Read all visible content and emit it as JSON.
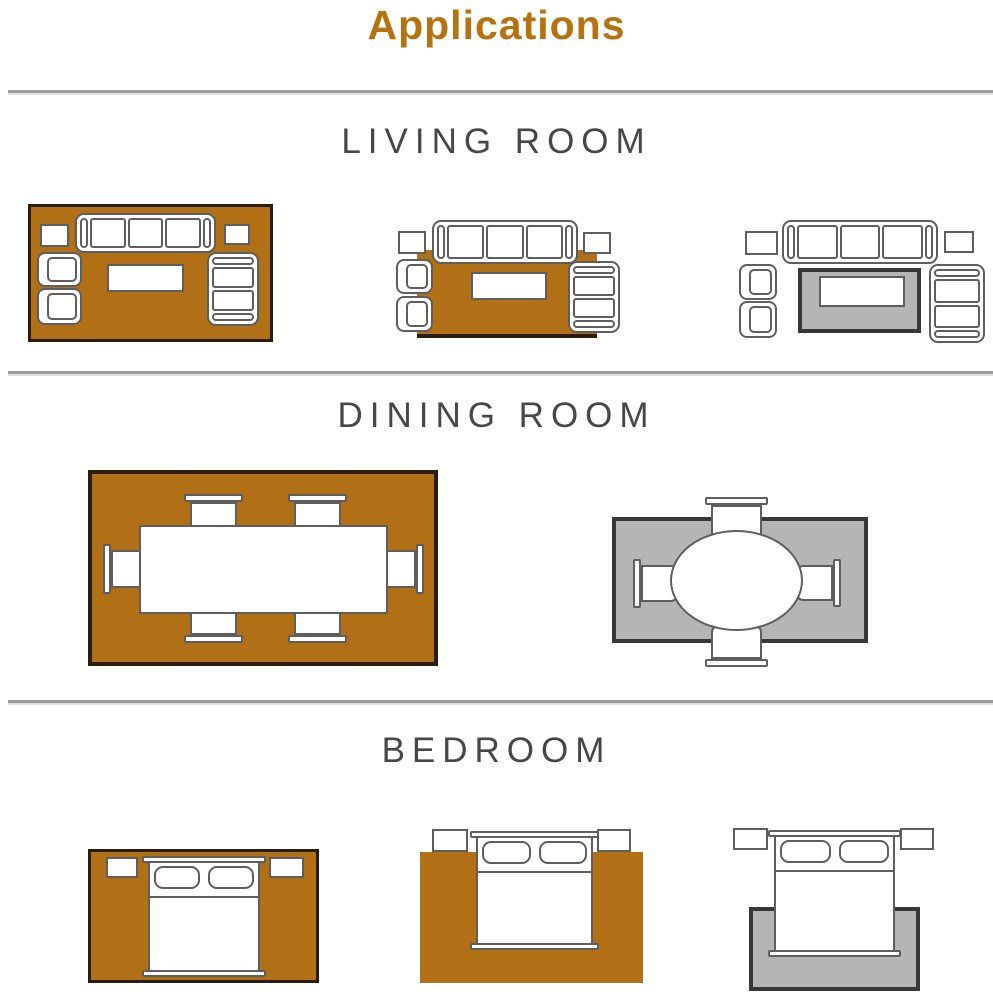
{
  "title": "Applications",
  "colors": {
    "title": "#b5720f",
    "heading": "#47474a",
    "divider": "#9d9d9d",
    "outline": "#5e5e5e",
    "rug_orange": "#b16f16",
    "rug_orange_border": "#2b1d0b",
    "rug_gray": "#b5b5b5",
    "rug_gray_border": "#383838",
    "background": "#ffffff"
  },
  "sections": [
    {
      "id": "living-room",
      "title": "LIVING ROOM",
      "layouts": [
        {
          "name": "all-furniture-on-rug",
          "rug": "orange",
          "furniture": [
            "sofa",
            "side-table-left",
            "side-table-right",
            "armchair-1",
            "armchair-2",
            "loveseat",
            "coffee-table"
          ]
        },
        {
          "name": "front-legs-on-rug",
          "rug": "orange",
          "furniture": [
            "sofa",
            "side-table-left",
            "side-table-right",
            "armchair-1",
            "armchair-2",
            "loveseat",
            "coffee-table"
          ]
        },
        {
          "name": "coffee-table-only-on-rug",
          "rug": "gray",
          "furniture": [
            "sofa",
            "side-table-left",
            "side-table-right",
            "armchair-1",
            "armchair-2",
            "loveseat",
            "coffee-table"
          ]
        }
      ]
    },
    {
      "id": "dining-room",
      "title": "DINING ROOM",
      "layouts": [
        {
          "name": "rectangular-table-six-chairs",
          "rug": "orange",
          "furniture": [
            "dining-table",
            "chair-top-1",
            "chair-top-2",
            "chair-bottom-1",
            "chair-bottom-2",
            "chair-left",
            "chair-right"
          ]
        },
        {
          "name": "round-table-four-chairs",
          "rug": "gray",
          "furniture": [
            "round-table",
            "chair-top",
            "chair-bottom",
            "chair-left",
            "chair-right"
          ]
        }
      ]
    },
    {
      "id": "bedroom",
      "title": "BEDROOM",
      "layouts": [
        {
          "name": "bed-fully-on-rug",
          "rug": "orange",
          "furniture": [
            "bed",
            "nightstand-left",
            "nightstand-right"
          ]
        },
        {
          "name": "bed-two-thirds-on-rug",
          "rug": "orange",
          "furniture": [
            "bed",
            "nightstand-left",
            "nightstand-right"
          ]
        },
        {
          "name": "rug-under-foot-of-bed",
          "rug": "gray",
          "furniture": [
            "bed",
            "nightstand-left",
            "nightstand-right"
          ]
        }
      ]
    }
  ]
}
